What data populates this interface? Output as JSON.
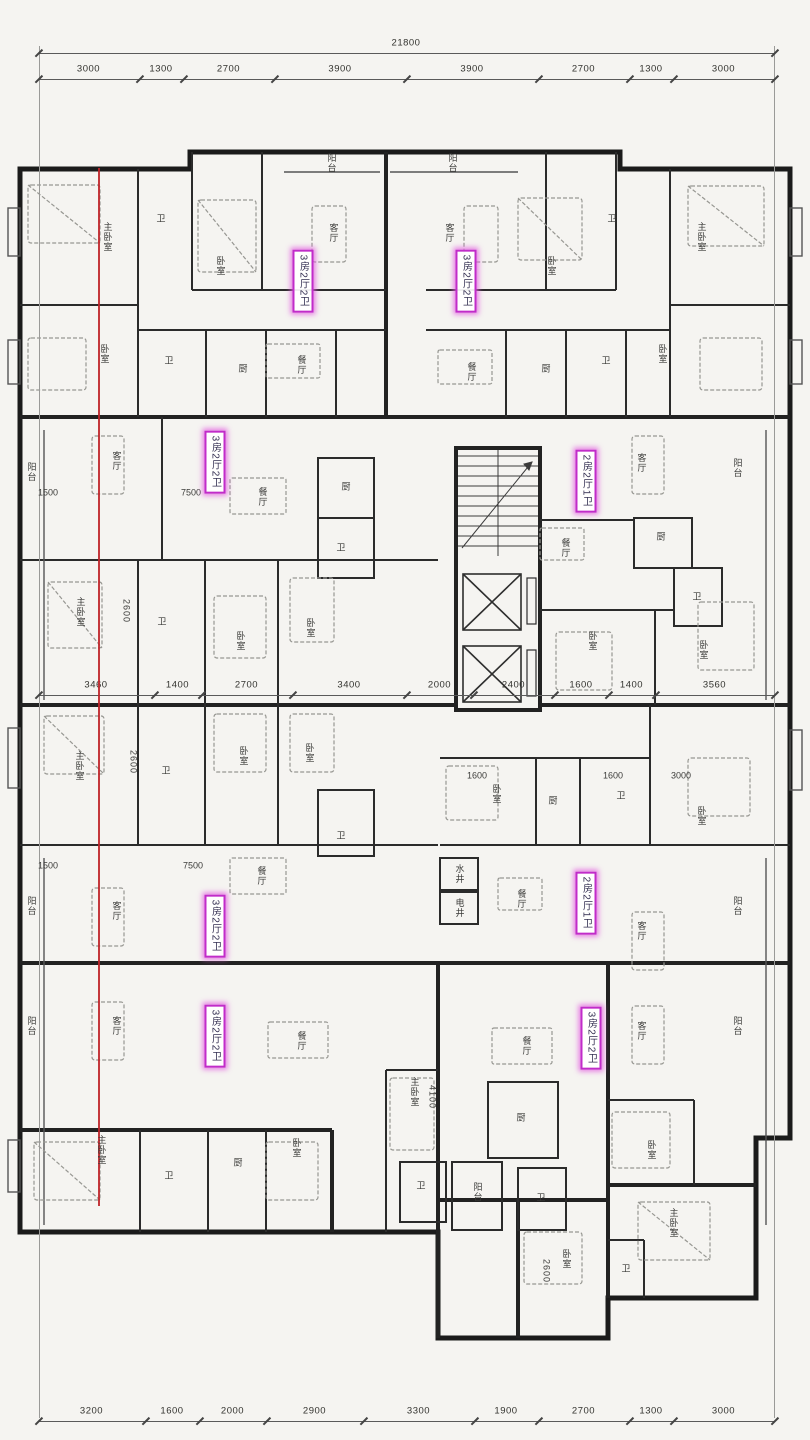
{
  "plan": {
    "title": "residential-floor-plan",
    "accent_color": "#c12cc9",
    "red_line": {
      "x": 98,
      "y1": 168,
      "y2": 1206,
      "color": "#bf2328"
    }
  },
  "dimension_rows": [
    {
      "name": "top-total",
      "y": 40,
      "ticks": [
        38,
        774
      ],
      "values": [
        "21800"
      ]
    },
    {
      "name": "top-segments",
      "y": 66,
      "ticks": [
        38,
        139,
        183,
        274,
        406,
        538,
        629,
        673,
        774
      ],
      "values": [
        "3000",
        "1300",
        "2700",
        "3900",
        "3900",
        "2700",
        "1300",
        "3000"
      ]
    },
    {
      "name": "middle-segments",
      "y": 682,
      "ticks": [
        38,
        154,
        201,
        292,
        406,
        473,
        554,
        608,
        655,
        774
      ],
      "values": [
        "3460",
        "1400",
        "2700",
        "3400",
        "2000",
        "2400",
        "1600",
        "1400",
        "3560"
      ]
    },
    {
      "name": "bottom-segments",
      "y": 1408,
      "ticks": [
        38,
        145,
        199,
        266,
        363,
        474,
        538,
        629,
        673,
        774
      ],
      "values": [
        "3200",
        "1600",
        "2000",
        "2900",
        "3300",
        "1900",
        "2700",
        "1300",
        "3000"
      ]
    }
  ],
  "unit_labels": [
    {
      "t": "3房2厅2卫",
      "x": 303,
      "y": 281
    },
    {
      "t": "3房2厅2卫",
      "x": 466,
      "y": 281
    },
    {
      "t": "3房2厅2卫",
      "x": 215,
      "y": 462
    },
    {
      "t": "2房2厅1卫",
      "x": 586,
      "y": 481
    },
    {
      "t": "3房2厅2卫",
      "x": 215,
      "y": 926
    },
    {
      "t": "2房2厅1卫",
      "x": 586,
      "y": 903
    },
    {
      "t": "3房2厅2卫",
      "x": 215,
      "y": 1036
    },
    {
      "t": "3房2厅2卫",
      "x": 591,
      "y": 1038
    }
  ],
  "labels": [
    {
      "t": "阳台",
      "x": 331,
      "y": 163,
      "v": 1
    },
    {
      "t": "阳台",
      "x": 452,
      "y": 163,
      "v": 1
    },
    {
      "t": "主卧室",
      "x": 107,
      "y": 237,
      "v": 1
    },
    {
      "t": "卫",
      "x": 161,
      "y": 219
    },
    {
      "t": "卧室",
      "x": 220,
      "y": 266,
      "v": 1
    },
    {
      "t": "客厅",
      "x": 333,
      "y": 233,
      "v": 1
    },
    {
      "t": "客厅",
      "x": 449,
      "y": 233,
      "v": 1
    },
    {
      "t": "卧室",
      "x": 551,
      "y": 266,
      "v": 1
    },
    {
      "t": "卫",
      "x": 612,
      "y": 219
    },
    {
      "t": "主卧室",
      "x": 701,
      "y": 237,
      "v": 1
    },
    {
      "t": "卧室",
      "x": 104,
      "y": 354,
      "v": 1
    },
    {
      "t": "卫",
      "x": 169,
      "y": 361
    },
    {
      "t": "厨",
      "x": 243,
      "y": 369
    },
    {
      "t": "餐厅",
      "x": 301,
      "y": 365,
      "v": 1
    },
    {
      "t": "餐厅",
      "x": 471,
      "y": 372,
      "v": 1
    },
    {
      "t": "厨",
      "x": 546,
      "y": 369
    },
    {
      "t": "卫",
      "x": 606,
      "y": 361
    },
    {
      "t": "卧室",
      "x": 662,
      "y": 354,
      "v": 1
    },
    {
      "t": "阳台",
      "x": 31,
      "y": 472,
      "v": 1
    },
    {
      "t": "客厅",
      "x": 116,
      "y": 461,
      "v": 1
    },
    {
      "t": "餐厅",
      "x": 262,
      "y": 497,
      "v": 1
    },
    {
      "t": "厨",
      "x": 346,
      "y": 487
    },
    {
      "t": "卫",
      "x": 341,
      "y": 548
    },
    {
      "t": "主卧室",
      "x": 80,
      "y": 612,
      "v": 1
    },
    {
      "t": "卫",
      "x": 162,
      "y": 622
    },
    {
      "t": "卧室",
      "x": 240,
      "y": 641,
      "v": 1
    },
    {
      "t": "卧室",
      "x": 310,
      "y": 628,
      "v": 1
    },
    {
      "t": "客厅",
      "x": 641,
      "y": 463,
      "v": 1
    },
    {
      "t": "阳台",
      "x": 737,
      "y": 468,
      "v": 1
    },
    {
      "t": "餐厅",
      "x": 565,
      "y": 548,
      "v": 1
    },
    {
      "t": "厨",
      "x": 661,
      "y": 537
    },
    {
      "t": "卫",
      "x": 697,
      "y": 597
    },
    {
      "t": "卧室",
      "x": 592,
      "y": 641,
      "v": 1
    },
    {
      "t": "卧室",
      "x": 703,
      "y": 650,
      "v": 1
    },
    {
      "t": "主卧室",
      "x": 79,
      "y": 766,
      "v": 1
    },
    {
      "t": "卫",
      "x": 166,
      "y": 771
    },
    {
      "t": "卧室",
      "x": 243,
      "y": 756,
      "v": 1
    },
    {
      "t": "卧室",
      "x": 309,
      "y": 753,
      "v": 1
    },
    {
      "t": "卫",
      "x": 341,
      "y": 836
    },
    {
      "t": "阳台",
      "x": 31,
      "y": 906,
      "v": 1
    },
    {
      "t": "客厅",
      "x": 116,
      "y": 911,
      "v": 1
    },
    {
      "t": "餐厅",
      "x": 261,
      "y": 876,
      "v": 1
    },
    {
      "t": "卧室",
      "x": 496,
      "y": 794,
      "v": 1
    },
    {
      "t": "厨",
      "x": 553,
      "y": 801
    },
    {
      "t": "卫",
      "x": 621,
      "y": 796
    },
    {
      "t": "卧室",
      "x": 701,
      "y": 816,
      "v": 1
    },
    {
      "t": "水井",
      "x": 459,
      "y": 874,
      "v": 1
    },
    {
      "t": "电井",
      "x": 459,
      "y": 908,
      "v": 1
    },
    {
      "t": "餐厅",
      "x": 521,
      "y": 899,
      "v": 1
    },
    {
      "t": "客厅",
      "x": 641,
      "y": 931,
      "v": 1
    },
    {
      "t": "阳台",
      "x": 737,
      "y": 906,
      "v": 1
    },
    {
      "t": "阳台",
      "x": 31,
      "y": 1026,
      "v": 1
    },
    {
      "t": "客厅",
      "x": 116,
      "y": 1026,
      "v": 1
    },
    {
      "t": "餐厅",
      "x": 301,
      "y": 1041,
      "v": 1
    },
    {
      "t": "餐厅",
      "x": 526,
      "y": 1046,
      "v": 1
    },
    {
      "t": "客厅",
      "x": 641,
      "y": 1031,
      "v": 1
    },
    {
      "t": "阳台",
      "x": 737,
      "y": 1026,
      "v": 1
    },
    {
      "t": "主卧室",
      "x": 414,
      "y": 1092,
      "v": 1
    },
    {
      "t": "厨",
      "x": 521,
      "y": 1118
    },
    {
      "t": "卫",
      "x": 421,
      "y": 1186
    },
    {
      "t": "阳台",
      "x": 477,
      "y": 1192,
      "v": 1
    },
    {
      "t": "卫",
      "x": 541,
      "y": 1198
    },
    {
      "t": "主卧室",
      "x": 101,
      "y": 1150,
      "v": 1
    },
    {
      "t": "卫",
      "x": 169,
      "y": 1176
    },
    {
      "t": "厨",
      "x": 238,
      "y": 1163
    },
    {
      "t": "卧室",
      "x": 296,
      "y": 1148,
      "v": 1
    },
    {
      "t": "卧室",
      "x": 651,
      "y": 1150,
      "v": 1
    },
    {
      "t": "主卧室",
      "x": 673,
      "y": 1223,
      "v": 1
    },
    {
      "t": "卧室",
      "x": 566,
      "y": 1259,
      "v": 1
    },
    {
      "t": "卫",
      "x": 626,
      "y": 1269
    },
    {
      "t": "1500",
      "x": 48,
      "y": 493,
      "c": "dimtx"
    },
    {
      "t": "7500",
      "x": 191,
      "y": 493,
      "c": "dimtx"
    },
    {
      "t": "2600",
      "x": 126,
      "y": 611,
      "v": 1,
      "c": "dimtx"
    },
    {
      "t": "1500",
      "x": 48,
      "y": 866,
      "c": "dimtx"
    },
    {
      "t": "7500",
      "x": 193,
      "y": 866,
      "c": "dimtx"
    },
    {
      "t": "2600",
      "x": 133,
      "y": 762,
      "v": 1,
      "c": "dimtx"
    },
    {
      "t": "1600",
      "x": 477,
      "y": 776,
      "c": "dimtx"
    },
    {
      "t": "1600",
      "x": 613,
      "y": 776,
      "c": "dimtx"
    },
    {
      "t": "3000",
      "x": 681,
      "y": 776,
      "c": "dimtx"
    },
    {
      "t": "4100",
      "x": 432,
      "y": 1097,
      "v": 1,
      "c": "dimtx"
    },
    {
      "t": "2600",
      "x": 546,
      "y": 1271,
      "v": 1,
      "c": "dimtx"
    }
  ]
}
